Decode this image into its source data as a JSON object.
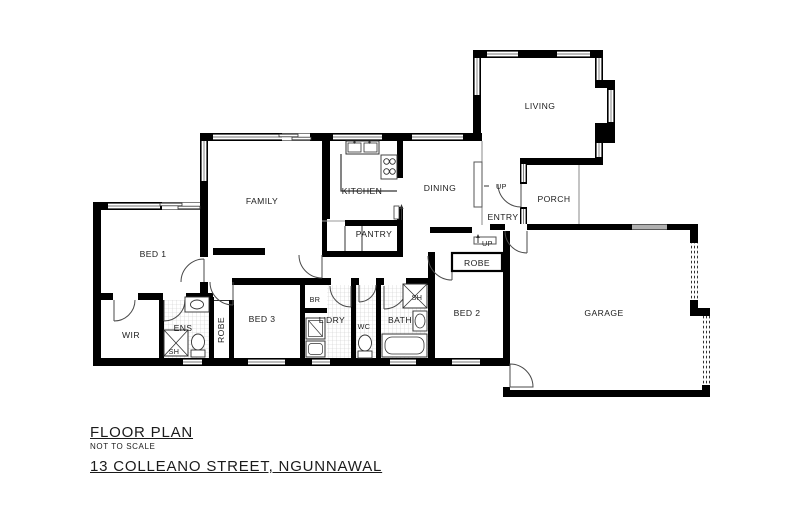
{
  "plan": {
    "labels": {
      "living": "LIVING",
      "porch": "PORCH",
      "entry": "ENTRY",
      "dining": "DINING",
      "kitchen": "KITCHEN",
      "pantry": "PANTRY",
      "family": "FAMILY",
      "bed1": "BED 1",
      "wir": "WIR",
      "ens": "ENS",
      "sh_ens": "SH",
      "robe_bed3": "ROBE",
      "bed3": "BED 3",
      "br": "BR",
      "ldry": "L'DRY",
      "wc": "WC",
      "bath": "BATH",
      "sh_bath": "SH",
      "bed2": "BED 2",
      "robe_bed2": "ROBE",
      "garage": "GARAGE",
      "up_entry": "UP",
      "up_hall": "UP"
    },
    "colors": {
      "wall": "#000000",
      "line": "#444444",
      "tile": "#c8c8c8"
    }
  },
  "footer": {
    "title": "FLOOR PLAN",
    "scale_note": "NOT TO SCALE",
    "address": "13 COLLEANO STREET, NGUNNAWAL"
  }
}
